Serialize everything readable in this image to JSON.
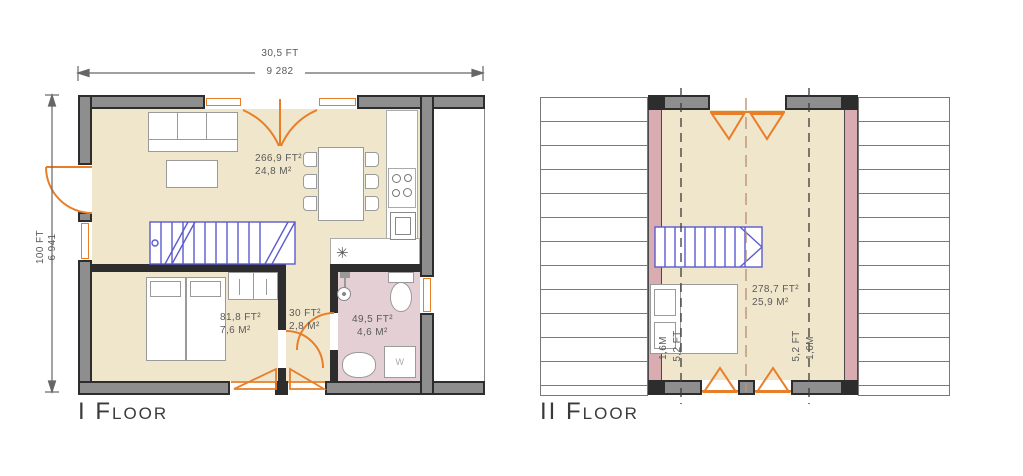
{
  "colors": {
    "door_orange": "#E87E28",
    "floor_beige": "#F0E6CC",
    "bathroom_pink": "#E4D0D4",
    "roof_mauve": "#D9ACB1",
    "wall_gray": "#8E8E8E",
    "wall_dark": "#2D2D2D",
    "stairs_blue": "#5B5BD0",
    "text_gray": "#5A5A5A"
  },
  "floor1": {
    "label": "I Floor",
    "dim_width": {
      "ft": "30,5 FT",
      "mm": "9 282"
    },
    "dim_height": {
      "ft": "100 FT",
      "mm": "6 941"
    },
    "living_room": {
      "area_ft": "266,9 FT²",
      "area_m": "24,8 M²"
    },
    "bedroom": {
      "area_ft": "81,8 FT²",
      "area_m": "7,6 M²"
    },
    "hall": {
      "area_ft": "30 FT²",
      "area_m": "2,8 M²"
    },
    "bathroom": {
      "area_ft": "49,5 FT²",
      "area_m": "4,6 M²"
    },
    "washer_label": "W",
    "fridge_icon": "✳"
  },
  "floor2": {
    "label": "II Floor",
    "room": {
      "area_ft": "278,7 FT²",
      "area_m": "25,9 M²"
    },
    "dim_left": {
      "m": "1,6M",
      "ft": "5,2 FT"
    },
    "dim_right": {
      "ft": "5,2 FT",
      "m": "1,6M"
    }
  }
}
